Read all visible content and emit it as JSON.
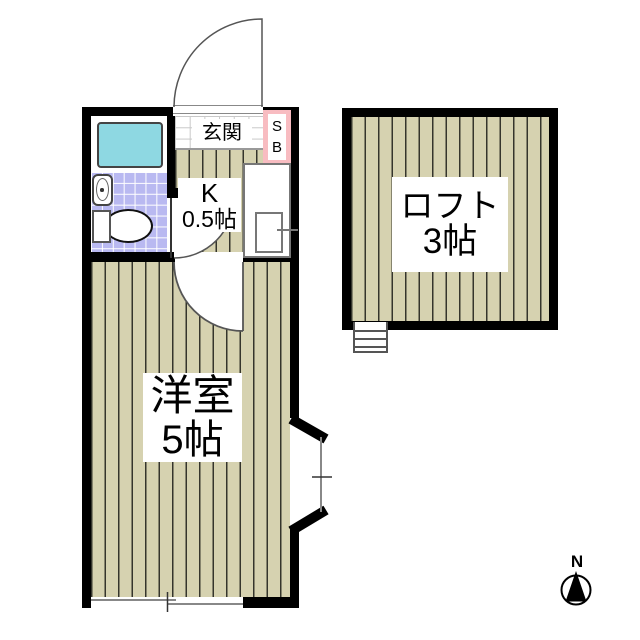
{
  "rooms": {
    "entrance": {
      "label": "玄関"
    },
    "kitchen": {
      "name": "K",
      "size": "0.5帖"
    },
    "western_room": {
      "name": "洋室",
      "size": "5帖"
    },
    "loft": {
      "name": "ロフト",
      "size": "3帖"
    }
  },
  "shoe_box": {
    "letters": [
      "S",
      "B"
    ]
  },
  "compass": {
    "north_label": "N"
  },
  "fixture_icons": [
    "bathtub-icon",
    "washbasin-icon",
    "toilet-icon",
    "kitchen-sink-icon",
    "entrance-door-icon",
    "room-door-icon",
    "bay-window-icon",
    "sliding-window-icon",
    "loft-ladder-icon",
    "compass-north-icon"
  ],
  "colors": {
    "wall": "#000000",
    "floor_plank": "#d6d2b0",
    "plank_line": "#35352c",
    "bath_tile": "#b9b9f1",
    "bathtub": "#8ed8e2",
    "shoe_box_pink": "#f8bcc1",
    "tile_line": "#c8c8c8",
    "door_line": "#555555",
    "window_line": "#888888",
    "fixture_line": "#444444"
  }
}
